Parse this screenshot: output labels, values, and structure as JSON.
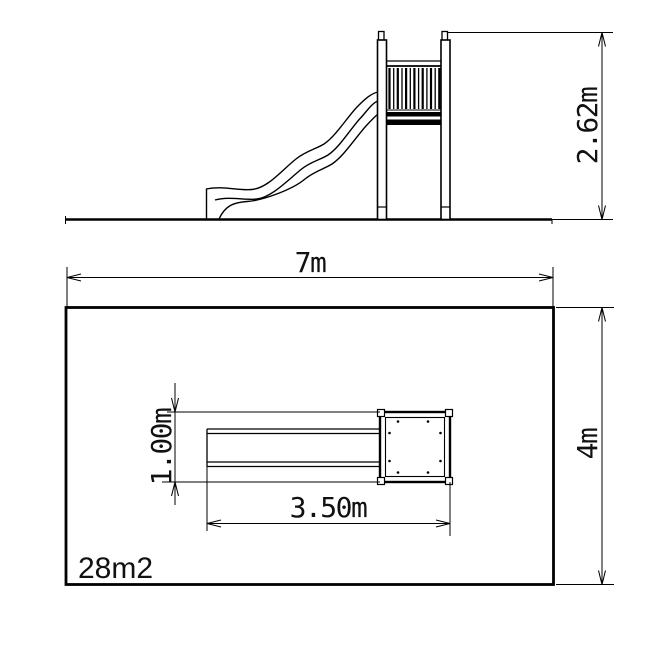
{
  "drawing": {
    "labels": {
      "elevation_height": "2.62m",
      "plan_width": "7m",
      "plan_depth": "4m",
      "footprint_length": "3.50m",
      "footprint_width": "1.00m",
      "area": "28m2"
    },
    "colors": {
      "line": "#000000",
      "background": "#ffffff",
      "text": "#111111"
    }
  }
}
